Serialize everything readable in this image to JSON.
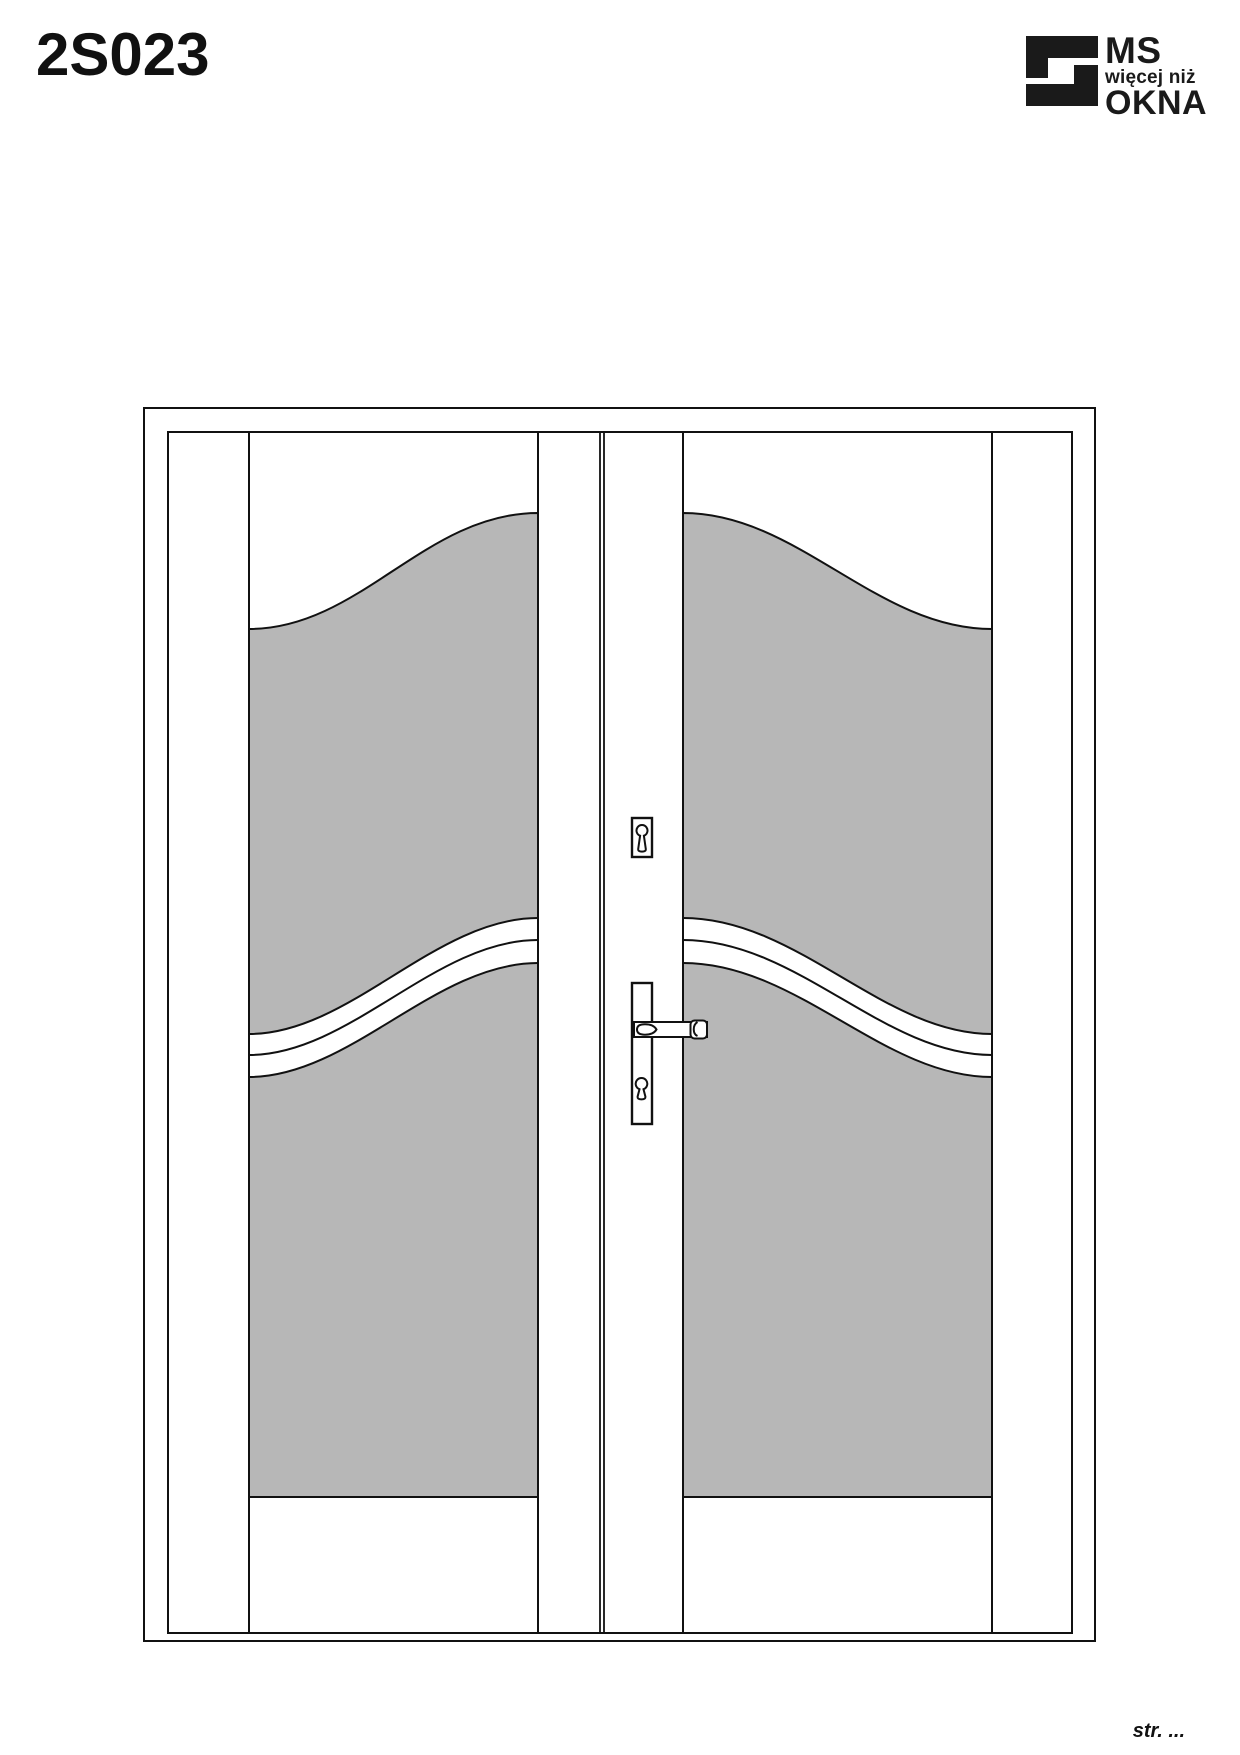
{
  "header": {
    "model_code": "2S023"
  },
  "logo": {
    "brand_top": "MS",
    "brand_tagline": "więcej niż",
    "brand_bottom": "OKNA",
    "mark_color": "#1a1a1a"
  },
  "drawing": {
    "glass_color": "#b7b7b7",
    "outline_color": "#111111"
  },
  "footer": {
    "page_label": "str. ..."
  }
}
